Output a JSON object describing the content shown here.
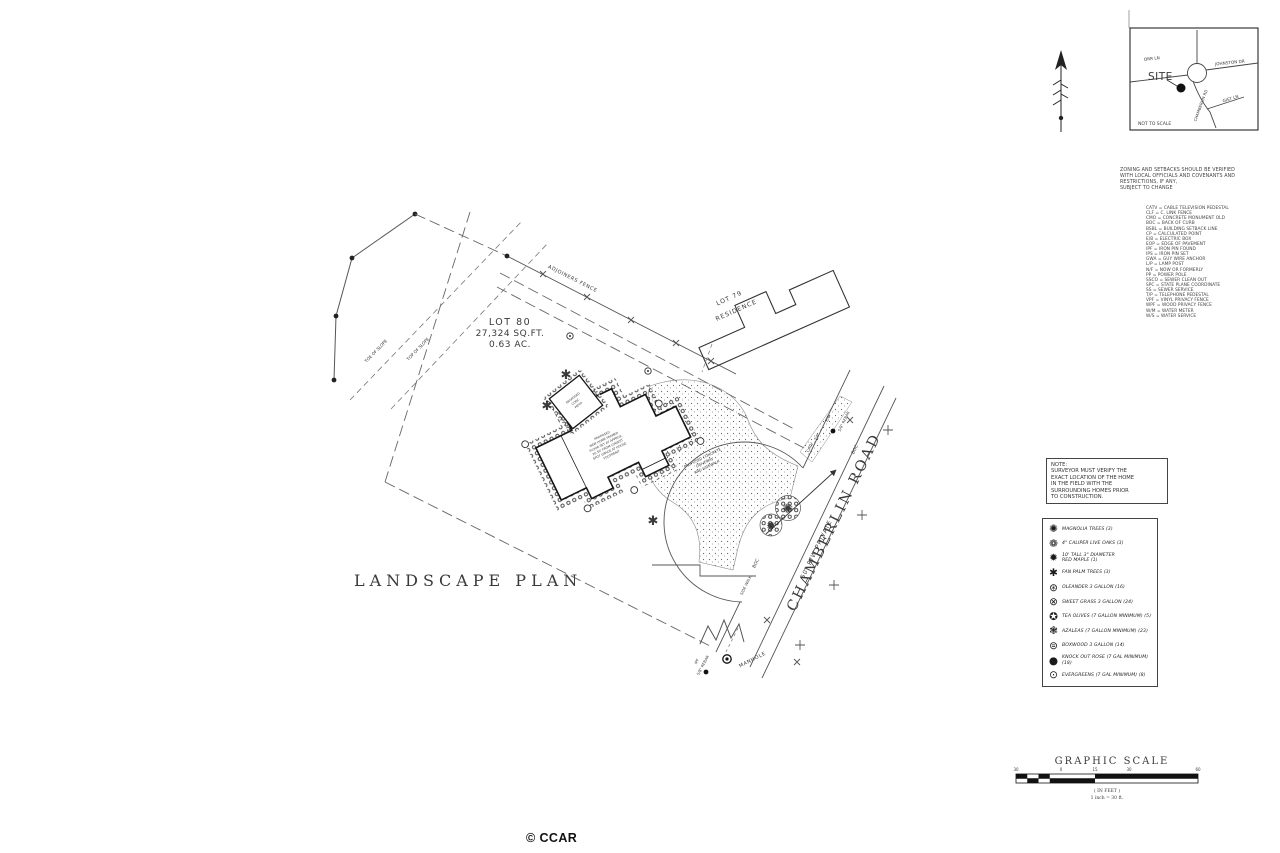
{
  "credit": "© CCAR",
  "inset_map": {
    "site": "SITE",
    "orr_ln": "ORR LN",
    "johnston_dr": "JOHNSTON DR",
    "chamberlin_rd": "CHAMBERLIN RD",
    "gist_ln": "GIST LN",
    "not_to_scale": "NOT TO SCALE"
  },
  "zoning_note": {
    "lines": [
      "ZONING AND SETBACKS SHOULD BE VERIFIED",
      "WITH LOCAL OFFICIALS AND COVENANTS AND",
      "RESTRICTIONS, IF ANY,",
      "SUBJECT TO CHANGE"
    ]
  },
  "abbreviations": [
    "CATV = CABLE TELEVISION PEDESTAL",
    "CLF = C. LINK FENCE",
    "CMO = CONCRETE MONUMENT OLD",
    "BOC = BACK OF CURB",
    "BSBL = BUILDING SETBACK LINE",
    "CP = CALCULATED POINT",
    "E/B = ELECTRIC BOX",
    "EOP = EDGE OF PAVEMENT",
    "IPF = IRON PIN FOUND",
    "IPS = IRON PIN SET",
    "GWA = GUY WIRE ANCHOR",
    "L/P = LAMP POST",
    "N/F = NOW OR FORMERLY",
    "PP = POWER POLE",
    "SSCO = SEWER CLEAN OUT",
    "SPC = STATE PLANE COORDINATE",
    "SS = SEWER SERVICE",
    "T/P = TELEPHONE PEDESTAL",
    "VPF = VINYL PRIVACY FENCE",
    "WPF = WOOD PRIVACY FENCE",
    "W/M = WATER METER",
    "W/S = WATER SERVICE"
  ],
  "note_box": {
    "title": "NOTE:",
    "lines": [
      "SURVEYOR MUST VERIFY THE",
      "EXACT LOCATION OF THE HOME",
      "IN THE FIELD WITH THE",
      "SURROUNDING HOMES PRIOR",
      "TO CONSTRUCTION."
    ]
  },
  "plant_legend": {
    "items": [
      {
        "icon": "magnolia-tree-icon",
        "glyph": "✺",
        "label": "MAGNOLIA TREES (3)"
      },
      {
        "icon": "live-oak-icon",
        "glyph": "❁",
        "label": "4\" CALIPER LIVE OAKS (3)"
      },
      {
        "icon": "red-maple-icon",
        "glyph": "✹",
        "label": "10' TALL 3\" DIAMETER\nRED MAPLE (1)"
      },
      {
        "icon": "fan-palm-icon",
        "glyph": "✱",
        "label": "FAN PALM TREES (3)"
      },
      {
        "icon": "oleander-icon",
        "glyph": "⊛",
        "label": "OLEANDER 3 GALLON (16)"
      },
      {
        "icon": "sweet-grass-icon",
        "glyph": "⊗",
        "label": "SWEET GRASS 3 GALLON (24)"
      },
      {
        "icon": "tea-olive-icon",
        "glyph": "✪",
        "label": "TEA OLIVES (7 GALLON MINIMUM) (5)"
      },
      {
        "icon": "azalea-icon",
        "glyph": "❃",
        "label": "AZALEAS (7 GALLON MINIMUM) (23)"
      },
      {
        "icon": "boxwood-icon",
        "glyph": "⊜",
        "label": "BOXWOOD 3 GALLON (14)"
      },
      {
        "icon": "knock-out-rose-icon",
        "glyph": "●",
        "label": "KNOCK OUT ROSE (7 GAL MINIMUM) (18)"
      },
      {
        "icon": "evergreen-icon",
        "glyph": "⊙",
        "label": "EVERGREENS (7 GAL MINIMUM) (8)"
      }
    ]
  },
  "graphic_scale": {
    "title": "GRAPHIC SCALE",
    "ticks": [
      "30",
      "0",
      "15",
      "30",
      "60"
    ],
    "units": "( IN FEET )",
    "ratio": "1 inch = 30 ft."
  },
  "plan": {
    "title": "LANDSCAPE PLAN",
    "lot80": {
      "name": "LOT 80",
      "sqft": "27,324 SQ.FT.",
      "acres": "0.63 AC."
    },
    "lot79": {
      "line1": "LOT 79",
      "line2": "RESIDENCE"
    },
    "road": {
      "name": "CHAMBERLIN ROAD",
      "rw": "50' R/W  PRIVATE",
      "boc": "BOC",
      "sidewalk": "SIDE WALK"
    },
    "labels": {
      "adjoiners_fence": "ADJOINERS FENCE",
      "toe_of_slope": "TOE OF SLOPE",
      "top_of_slope": "TOP OF SLOPE",
      "manhole": "MANHOLE",
      "ipf": "IPF",
      "rebar": "5/8\" REBAR",
      "catv": "CATV",
      "tp": "T/P",
      "eb": "E/B"
    },
    "house_note": [
      "PROPOSED",
      "NEW HOME FRAMED",
      "FLOOR SET AT APPROX.",
      "26.50' FROM LOWEST",
      "SPOT GRADE AT HOUSE",
      "FOOTPRINT"
    ],
    "driveway_note": [
      "PROPOSED  CONCRETE",
      "DRIVEWAY",
      "AND SIDEWALK"
    ],
    "patio_note": [
      "PROPOSED",
      "CONC.",
      "PATIO"
    ],
    "symbols": {
      "fan_palm": "✱",
      "magnolia": "✺",
      "red_maple": "✹"
    }
  }
}
